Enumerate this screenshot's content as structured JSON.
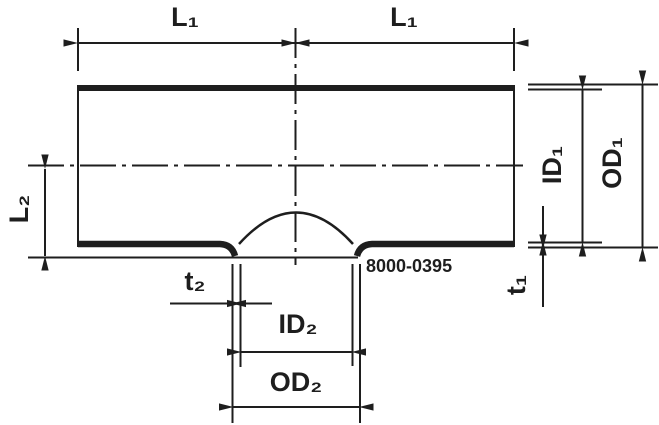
{
  "drawing": {
    "type": "pipe-tee-section-diagram",
    "part_number": "8000-0395",
    "dimensions": {
      "l1_left": "L₁",
      "l1_right": "L₁",
      "l2": "L₂",
      "id1": "ID₁",
      "od1": "OD₁",
      "t1": "t₁",
      "t2": "t₂",
      "id2": "ID₂",
      "od2": "OD₂"
    },
    "colors": {
      "ink": "#1e1e1e",
      "background": "#ffffff"
    }
  }
}
